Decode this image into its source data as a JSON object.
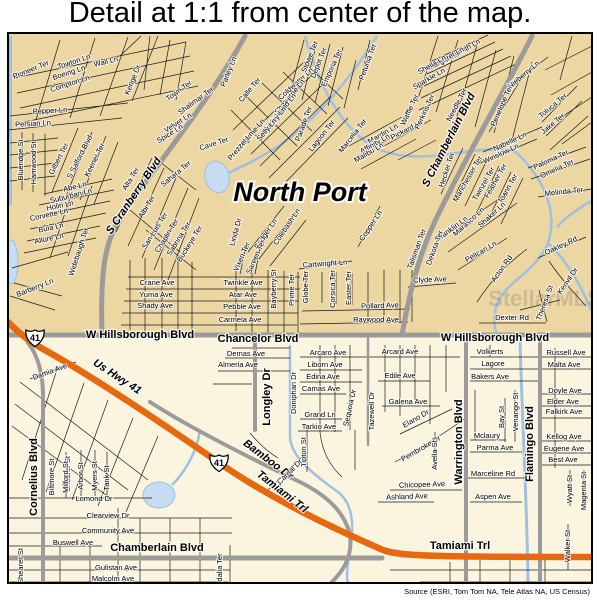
{
  "title": "Detail at 1:1 from center of the map.",
  "attribution": "Source (ESRI, Tom Tom NA, Tele Atlas NA, US Census)",
  "map": {
    "colors": {
      "land_upper": "#ecd6a2",
      "land_lower": "#fbf5df",
      "major_road": "#9b9b99",
      "highway": "#e8680f",
      "water": "#9fc0e2",
      "label": "#000000"
    },
    "shields": [
      {
        "label": "41",
        "x": 35,
        "y": 338
      },
      {
        "label": "41",
        "x": 219,
        "y": 463
      }
    ],
    "labels": [
      {
        "t": "North Port",
        "x": 300,
        "y": 194,
        "r": 0,
        "k": "city",
        "n": "city-label"
      },
      {
        "t": "StellarMLS",
        "x": 545,
        "y": 300,
        "r": 0,
        "k": "wm",
        "n": "watermark-text"
      },
      {
        "t": "S Cranberry Blvd",
        "x": 134,
        "y": 196,
        "r": -56,
        "k": "major",
        "i": 1,
        "n": "road-label"
      },
      {
        "t": "S Chamberlain Blvd",
        "x": 449,
        "y": 140,
        "r": -63,
        "k": "major",
        "i": 1,
        "n": "road-label"
      },
      {
        "t": "W Hillsborough Blvd",
        "x": 140,
        "y": 335,
        "r": 0,
        "k": "major",
        "n": "road-label"
      },
      {
        "t": "Chancelor Blvd",
        "x": 258,
        "y": 339,
        "r": 0,
        "k": "major",
        "n": "road-label"
      },
      {
        "t": "W Hillsborough Blvd",
        "x": 495,
        "y": 338,
        "r": 0,
        "k": "major",
        "n": "road-label"
      },
      {
        "t": "Us Hwy 41",
        "x": 117,
        "y": 377,
        "r": 33,
        "k": "major",
        "i": 1,
        "n": "road-label"
      },
      {
        "t": "Tamiami Trl",
        "x": 282,
        "y": 492,
        "r": 38,
        "k": "major",
        "i": 1,
        "n": "road-label"
      },
      {
        "t": "Tamiami Trl",
        "x": 460,
        "y": 546,
        "r": 0,
        "k": "major",
        "n": "road-label"
      },
      {
        "t": "Bamboo Dr",
        "x": 268,
        "y": 460,
        "r": 37,
        "k": "major",
        "i": 1,
        "n": "road-label"
      },
      {
        "t": "Chamberlain Blvd",
        "x": 157,
        "y": 548,
        "r": 0,
        "k": "major",
        "n": "road-label"
      },
      {
        "t": "Cornelius Blvd",
        "x": 34,
        "y": 477,
        "r": -90,
        "k": "major",
        "n": "road-label"
      },
      {
        "t": "Longley Dr",
        "x": 267,
        "y": 397,
        "r": -90,
        "k": "major",
        "n": "road-label"
      },
      {
        "t": "Warrington Blvd",
        "x": 459,
        "y": 442,
        "r": -90,
        "k": "major",
        "n": "road-label"
      },
      {
        "t": "Flamingo Blvd",
        "x": 530,
        "y": 444,
        "r": -90,
        "k": "major",
        "n": "road-label"
      },
      {
        "t": "Pioneer Ter",
        "x": 31,
        "y": 70,
        "r": -22
      },
      {
        "t": "Towton Ln",
        "x": 74,
        "y": 62,
        "r": -18
      },
      {
        "t": "Boeing Ln",
        "x": 69,
        "y": 73,
        "r": -18
      },
      {
        "t": "Compton Ln",
        "x": 70,
        "y": 84,
        "r": -18
      },
      {
        "t": "Wall Ln",
        "x": 106,
        "y": 62,
        "r": -14
      },
      {
        "t": "Kenge Dr",
        "x": 133,
        "y": 80,
        "r": -68
      },
      {
        "t": "Town Ter",
        "x": 179,
        "y": 91,
        "r": -36
      },
      {
        "t": "Shalimar Ter",
        "x": 196,
        "y": 101,
        "r": -36
      },
      {
        "t": "Velvet Ln",
        "x": 178,
        "y": 123,
        "r": -32
      },
      {
        "t": "Spice Ln",
        "x": 170,
        "y": 134,
        "r": -32
      },
      {
        "t": "Sahara Ter",
        "x": 176,
        "y": 174,
        "r": -40
      },
      {
        "t": "Pepper Ln",
        "x": 50,
        "y": 111,
        "r": -3
      },
      {
        "t": "Persian Ln",
        "x": 33,
        "y": 124,
        "r": -3
      },
      {
        "t": "Blueridge St",
        "x": 21,
        "y": 160,
        "r": -90
      },
      {
        "t": "Hamwood St",
        "x": 34,
        "y": 163,
        "r": -90
      },
      {
        "t": "Gilbert Ter",
        "x": 59,
        "y": 159,
        "r": -63
      },
      {
        "t": "S Salford Blvd",
        "x": 80,
        "y": 157,
        "r": -63
      },
      {
        "t": "Keener Ter",
        "x": 95,
        "y": 160,
        "r": -63
      },
      {
        "t": "Abe Ln",
        "x": 75,
        "y": 187,
        "r": -14
      },
      {
        "t": "Suburban Ln",
        "x": 71,
        "y": 196,
        "r": -14
      },
      {
        "t": "Holin Ln",
        "x": 60,
        "y": 206,
        "r": -12
      },
      {
        "t": "Corvette Ln",
        "x": 49,
        "y": 215,
        "r": -12
      },
      {
        "t": "Bula Ln",
        "x": 51,
        "y": 228,
        "r": -12
      },
      {
        "t": "Allure Ln",
        "x": 49,
        "y": 239,
        "r": -12
      },
      {
        "t": "Widebaugh Ter",
        "x": 79,
        "y": 252,
        "r": -72
      },
      {
        "t": "Barberry Ln",
        "x": 35,
        "y": 288,
        "r": -22
      },
      {
        "t": "Alta Ter",
        "x": 131,
        "y": 179,
        "r": -58
      },
      {
        "t": "Albi Ter",
        "x": 147,
        "y": 207,
        "r": -58
      },
      {
        "t": "San Luis Ter",
        "x": 155,
        "y": 231,
        "r": -58
      },
      {
        "t": "Chaplin Ter",
        "x": 167,
        "y": 236,
        "r": -58
      },
      {
        "t": "Sabrina Ter",
        "x": 179,
        "y": 239,
        "r": -58
      },
      {
        "t": "Buckeye Ter",
        "x": 190,
        "y": 244,
        "r": -58
      },
      {
        "t": "Calle Ter",
        "x": 250,
        "y": 90,
        "r": -50
      },
      {
        "t": "Parley Ln",
        "x": 229,
        "y": 72,
        "r": -68
      },
      {
        "t": "Cave Ter",
        "x": 214,
        "y": 144,
        "r": -18
      },
      {
        "t": "Coldwater Ln",
        "x": 296,
        "y": 84,
        "r": -42
      },
      {
        "t": "Stowe Ter",
        "x": 310,
        "y": 57,
        "r": -68
      },
      {
        "t": "Depot Ter",
        "x": 319,
        "y": 63,
        "r": -68
      },
      {
        "t": "Emporia Ter",
        "x": 332,
        "y": 68,
        "r": -66
      },
      {
        "t": "Shaborne Ln",
        "x": 290,
        "y": 97,
        "r": -50
      },
      {
        "t": "Ashland Ln",
        "x": 283,
        "y": 109,
        "r": -50
      },
      {
        "t": "Parley Ln",
        "x": 275,
        "y": 120,
        "r": -50
      },
      {
        "t": "Selly Ln",
        "x": 267,
        "y": 130,
        "r": -50
      },
      {
        "t": "Magione Ln",
        "x": 251,
        "y": 135,
        "r": -50
      },
      {
        "t": "Prezzel Ln",
        "x": 241,
        "y": 146,
        "r": -50
      },
      {
        "t": "Parade Ter",
        "x": 304,
        "y": 124,
        "r": -70
      },
      {
        "t": "Lagoon Ter",
        "x": 322,
        "y": 136,
        "r": -52
      },
      {
        "t": "Petunia Ter",
        "x": 368,
        "y": 62,
        "r": -70
      },
      {
        "t": "Marcelia Ter",
        "x": 353,
        "y": 136,
        "r": -52
      },
      {
        "t": "Mardin Ln",
        "x": 383,
        "y": 134,
        "r": -30
      },
      {
        "t": "Affinity Ln",
        "x": 375,
        "y": 144,
        "r": -30
      },
      {
        "t": "Malibu Ln",
        "x": 369,
        "y": 153,
        "r": -30
      },
      {
        "t": "Pickard Ln",
        "x": 407,
        "y": 130,
        "r": -28
      },
      {
        "t": "Linda Dr",
        "x": 236,
        "y": 232,
        "r": -75
      },
      {
        "t": "Badger Ln",
        "x": 266,
        "y": 234,
        "r": -56
      },
      {
        "t": "Colebash Ln",
        "x": 287,
        "y": 227,
        "r": -56
      },
      {
        "t": "Vixen Ter",
        "x": 242,
        "y": 257,
        "r": -66
      },
      {
        "t": "Sareen Ter",
        "x": 256,
        "y": 257,
        "r": -66
      },
      {
        "t": "Copper Ln",
        "x": 371,
        "y": 226,
        "r": -56
      },
      {
        "t": "Cartwright Ln",
        "x": 325,
        "y": 264,
        "r": -4
      },
      {
        "t": "Twinkle Ave",
        "x": 243,
        "y": 283,
        "r": 0
      },
      {
        "t": "Atar Ave",
        "x": 243,
        "y": 295,
        "r": 0
      },
      {
        "t": "Pebble Ave",
        "x": 242,
        "y": 307,
        "r": 0
      },
      {
        "t": "Carmela Ave",
        "x": 240,
        "y": 320,
        "r": 0
      },
      {
        "t": "Crane Ave",
        "x": 157,
        "y": 283,
        "r": 0
      },
      {
        "t": "Yuma Ave",
        "x": 156,
        "y": 295,
        "r": 0
      },
      {
        "t": "Shady Ave",
        "x": 155,
        "y": 306,
        "r": 0
      },
      {
        "t": "Bayberry St",
        "x": 274,
        "y": 289,
        "r": -90
      },
      {
        "t": "Prime Ter",
        "x": 292,
        "y": 290,
        "r": -90
      },
      {
        "t": "Globe Ter",
        "x": 306,
        "y": 287,
        "r": -90
      },
      {
        "t": "Corsica Ter",
        "x": 333,
        "y": 289,
        "r": -90
      },
      {
        "t": "Easter Ter",
        "x": 349,
        "y": 288,
        "r": -90
      },
      {
        "t": "Pollard Ave",
        "x": 380,
        "y": 306,
        "r": -2
      },
      {
        "t": "Raywood Ave",
        "x": 376,
        "y": 320,
        "r": 0
      },
      {
        "t": "Wintsmith Ln",
        "x": 461,
        "y": 52,
        "r": -30
      },
      {
        "t": "Margaret Ln",
        "x": 446,
        "y": 59,
        "r": -30
      },
      {
        "t": "Sheila Ln",
        "x": 432,
        "y": 65,
        "r": -30
      },
      {
        "t": "Sparkle Ln",
        "x": 429,
        "y": 79,
        "r": -30
      },
      {
        "t": "Nieberry Ln",
        "x": 524,
        "y": 75,
        "r": -40
      },
      {
        "t": "Needle Ter",
        "x": 457,
        "y": 105,
        "r": -62
      },
      {
        "t": "Waffle Ter",
        "x": 410,
        "y": 110,
        "r": -65
      },
      {
        "t": "Perkins Ter",
        "x": 425,
        "y": 112,
        "r": -65
      },
      {
        "t": "Penelope Ter",
        "x": 502,
        "y": 106,
        "r": -66
      },
      {
        "t": "Toluca Ter",
        "x": 553,
        "y": 106,
        "r": -40
      },
      {
        "t": "Jake Ter",
        "x": 553,
        "y": 124,
        "r": -40
      },
      {
        "t": "Nabelle Ln",
        "x": 510,
        "y": 142,
        "r": -25
      },
      {
        "t": "Winslow Ln",
        "x": 501,
        "y": 154,
        "r": -25
      },
      {
        "t": "Paloma Ter",
        "x": 551,
        "y": 160,
        "r": -25
      },
      {
        "t": "Omelia Ter",
        "x": 557,
        "y": 169,
        "r": -25
      },
      {
        "t": "Melinda Ter",
        "x": 564,
        "y": 192,
        "r": -6
      },
      {
        "t": "Hecker Ter",
        "x": 447,
        "y": 170,
        "r": -72
      },
      {
        "t": "Manchester Ter",
        "x": 468,
        "y": 179,
        "r": -60
      },
      {
        "t": "Twinzel Ter",
        "x": 484,
        "y": 184,
        "r": -60
      },
      {
        "t": "Feather Ter",
        "x": 496,
        "y": 181,
        "r": -60
      },
      {
        "t": "Joann Ter",
        "x": 508,
        "y": 189,
        "r": -60
      },
      {
        "t": "Shaker Ln",
        "x": 492,
        "y": 215,
        "r": -42
      },
      {
        "t": "Marasco Ln",
        "x": 469,
        "y": 222,
        "r": -42
      },
      {
        "t": "Franklin Ln",
        "x": 452,
        "y": 229,
        "r": -36
      },
      {
        "t": "Pelican Ln",
        "x": 481,
        "y": 252,
        "r": -30
      },
      {
        "t": "Dekota Ter",
        "x": 435,
        "y": 248,
        "r": -70
      },
      {
        "t": "Talisman Ter",
        "x": 417,
        "y": 249,
        "r": -70
      },
      {
        "t": "Clyde Ave",
        "x": 430,
        "y": 280,
        "r": -2
      },
      {
        "t": "Acton Rd",
        "x": 502,
        "y": 269,
        "r": -55
      },
      {
        "t": "Oakley Rd",
        "x": 561,
        "y": 246,
        "r": -25
      },
      {
        "t": "Kenvil Dr",
        "x": 568,
        "y": 281,
        "r": -55
      },
      {
        "t": "Theresa St",
        "x": 545,
        "y": 303,
        "r": -70
      },
      {
        "t": "Dexter Rd",
        "x": 512,
        "y": 318,
        "r": 0
      },
      {
        "t": "Damia Ave",
        "x": 50,
        "y": 372,
        "r": -20
      },
      {
        "t": "Shearer St",
        "x": 68,
        "y": 474,
        "r": -90
      },
      {
        "t": "Shearer St",
        "x": 21,
        "y": 566,
        "r": -90
      },
      {
        "t": "Biltmore St",
        "x": 52,
        "y": 477,
        "r": -90
      },
      {
        "t": "Milford St",
        "x": 66,
        "y": 477,
        "r": -90
      },
      {
        "t": "Arbor St",
        "x": 81,
        "y": 476,
        "r": -90
      },
      {
        "t": "Myers St",
        "x": 95,
        "y": 476,
        "r": -90
      },
      {
        "t": "Tank St",
        "x": 107,
        "y": 478,
        "r": -90
      },
      {
        "t": "Lomond Dr",
        "x": 94,
        "y": 499,
        "r": 0
      },
      {
        "t": "Clearview Dr",
        "x": 108,
        "y": 516,
        "r": 0
      },
      {
        "t": "Community Ave",
        "x": 108,
        "y": 531,
        "r": 0
      },
      {
        "t": "Buswell Ave",
        "x": 73,
        "y": 543,
        "r": 0
      },
      {
        "t": "Gulistan Ave",
        "x": 116,
        "y": 568,
        "r": 0
      },
      {
        "t": "Malcolm Ave",
        "x": 113,
        "y": 579,
        "r": 0
      },
      {
        "t": "Adalia Ter",
        "x": 220,
        "y": 570,
        "r": -90
      },
      {
        "t": "Demas Ave",
        "x": 246,
        "y": 354,
        "r": 0
      },
      {
        "t": "Almeria Ave",
        "x": 238,
        "y": 365,
        "r": 0
      },
      {
        "t": "Doniphan Dr",
        "x": 294,
        "y": 393,
        "r": -90
      },
      {
        "t": "Arcaro Ave",
        "x": 328,
        "y": 353,
        "r": 0
      },
      {
        "t": "Arcard Ave",
        "x": 400,
        "y": 352,
        "r": 0
      },
      {
        "t": "Liborn Ave",
        "x": 325,
        "y": 365,
        "r": 0
      },
      {
        "t": "Edina Ave",
        "x": 323,
        "y": 377,
        "r": 0
      },
      {
        "t": "Edile Ave",
        "x": 400,
        "y": 376,
        "r": 0
      },
      {
        "t": "Camas Ave",
        "x": 321,
        "y": 389,
        "r": 0
      },
      {
        "t": "Galena Ave",
        "x": 408,
        "y": 402,
        "r": 0
      },
      {
        "t": "Grand Ln",
        "x": 320,
        "y": 415,
        "r": 0
      },
      {
        "t": "Tarkio Ave",
        "x": 319,
        "y": 427,
        "r": 0
      },
      {
        "t": "Tipton St",
        "x": 304,
        "y": 452,
        "r": -90
      },
      {
        "t": "Sequoia Dr",
        "x": 350,
        "y": 408,
        "r": -78
      },
      {
        "t": "Tazewell Dr",
        "x": 372,
        "y": 411,
        "r": -90
      },
      {
        "t": "Caroal Dr",
        "x": 290,
        "y": 472,
        "r": -45
      },
      {
        "t": "Pembroke Dr",
        "x": 421,
        "y": 449,
        "r": -30
      },
      {
        "t": "Elano Dr",
        "x": 416,
        "y": 419,
        "r": -30
      },
      {
        "t": "Avella St",
        "x": 435,
        "y": 455,
        "r": -90
      },
      {
        "t": "Chicopee Ave",
        "x": 422,
        "y": 485,
        "r": -2
      },
      {
        "t": "Ashland Ave",
        "x": 407,
        "y": 497,
        "r": -2
      },
      {
        "t": "Aspen Ave",
        "x": 493,
        "y": 497,
        "r": 0
      },
      {
        "t": "Volkerts",
        "x": 490,
        "y": 352,
        "r": 0
      },
      {
        "t": "Lagore",
        "x": 493,
        "y": 364,
        "r": 0
      },
      {
        "t": "Bakers Ave",
        "x": 490,
        "y": 377,
        "r": 0
      },
      {
        "t": "Russell Ave",
        "x": 566,
        "y": 353,
        "r": 0
      },
      {
        "t": "Malta Ave",
        "x": 564,
        "y": 365,
        "r": 0
      },
      {
        "t": "Doyle Ave",
        "x": 565,
        "y": 391,
        "r": 0
      },
      {
        "t": "Elder Ave",
        "x": 563,
        "y": 402,
        "r": 0
      },
      {
        "t": "Falkirk Ave",
        "x": 564,
        "y": 412,
        "r": 0
      },
      {
        "t": "Kellog Ave",
        "x": 564,
        "y": 437,
        "r": 0
      },
      {
        "t": "Eugene Ave",
        "x": 564,
        "y": 449,
        "r": 0
      },
      {
        "t": "Best Ave",
        "x": 563,
        "y": 460,
        "r": 0
      },
      {
        "t": "Venango St",
        "x": 516,
        "y": 412,
        "r": -90
      },
      {
        "t": "Bay St",
        "x": 502,
        "y": 417,
        "r": -90
      },
      {
        "t": "Mclaury",
        "x": 487,
        "y": 436,
        "r": 0
      },
      {
        "t": "Parma Ave",
        "x": 495,
        "y": 448,
        "r": 0
      },
      {
        "t": "Marceline Rd",
        "x": 493,
        "y": 474,
        "r": 0
      },
      {
        "t": "Wyatt St",
        "x": 570,
        "y": 489,
        "r": -90
      },
      {
        "t": "Magenta St",
        "x": 584,
        "y": 491,
        "r": -90
      },
      {
        "t": "Walker St",
        "x": 568,
        "y": 546,
        "r": -90
      }
    ]
  }
}
